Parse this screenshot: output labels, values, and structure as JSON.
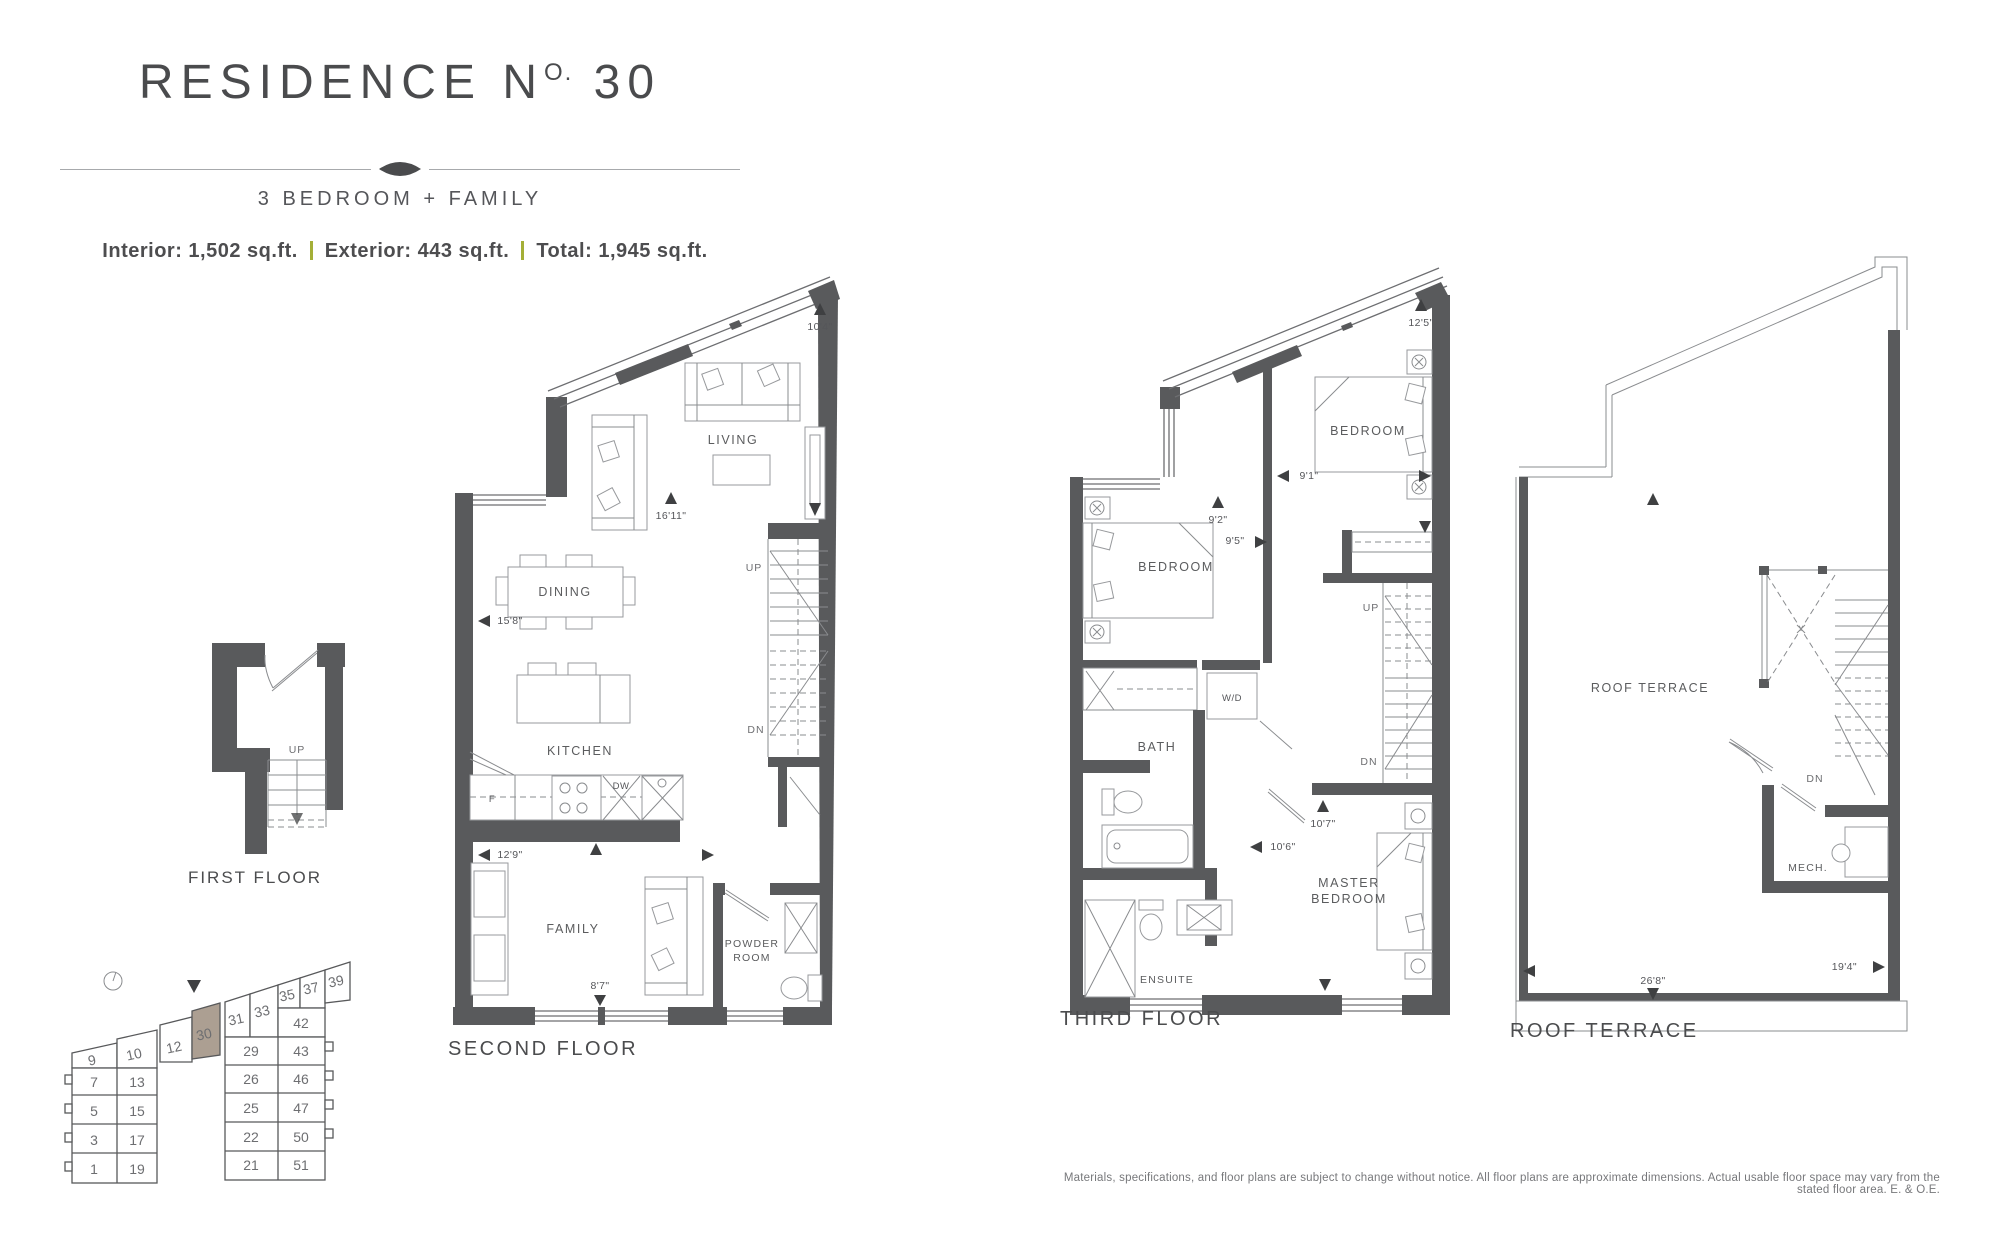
{
  "header": {
    "title_prefix": "RESIDENCE N",
    "title_sup": "O.",
    "title_suffix": "30",
    "subtitle": "3 BEDROOM + FAMILY",
    "stats": [
      "Interior: 1,502 sq.ft.",
      "Exterior: 443 sq.ft.",
      "Total: 1,945 sq.ft."
    ]
  },
  "floors": {
    "first": {
      "label": "FIRST FLOOR",
      "stairs": {
        "up": "UP"
      }
    },
    "second": {
      "label": "SECOND FLOOR",
      "rooms": {
        "living": "LIVING",
        "dining": "DINING",
        "kitchen": "KITCHEN",
        "family": "FAMILY",
        "powder1": "POWDER",
        "powder2": "ROOM"
      },
      "appliances": {
        "fridge": "F",
        "dishwasher": "DW"
      },
      "stairs": {
        "up": "UP",
        "dn": "DN"
      },
      "dims": {
        "living_width": "10'4\"",
        "living_depth": "16'11\"",
        "dining": "15'8\"",
        "family_width": "12'9\"",
        "family_depth": "8'7\""
      }
    },
    "third": {
      "label": "THIRD FLOOR",
      "rooms": {
        "bedroom_right": "BEDROOM",
        "bedroom_left": "BEDROOM",
        "bath": "BATH",
        "wd": "W/D",
        "master1": "MASTER",
        "master2": "BEDROOM",
        "ensuite": "ENSUITE"
      },
      "stairs": {
        "up": "UP",
        "dn": "DN"
      },
      "dims": {
        "bedroom_right_w": "12'5\"",
        "hall": "9'1\"",
        "bedroom_left_w": "9'2\"",
        "bedroom_left_d": "9'5\"",
        "master_w": "10'7\"",
        "master_d": "10'6\""
      }
    },
    "roof": {
      "label": "ROOF TERRACE",
      "rooms": {
        "terrace": "ROOF TERRACE",
        "mech": "MECH."
      },
      "stairs": {
        "dn": "DN"
      },
      "dims": {
        "width": "26'8\"",
        "depth": "19'4\""
      }
    }
  },
  "keyplan": {
    "highlighted_unit": "30",
    "units": [
      "9",
      "10",
      "12",
      "30",
      "31",
      "33",
      "35",
      "37",
      "39",
      "42",
      "29",
      "43",
      "26",
      "46",
      "25",
      "47",
      "22",
      "50",
      "21",
      "51",
      "7",
      "13",
      "5",
      "15",
      "3",
      "17",
      "1",
      "19"
    ]
  },
  "disclaimer": "Materials, specifications, and floor plans are subject to change without notice. All floor plans are approximate dimensions. Actual usable floor space may vary from the stated floor area. E. & O.E.",
  "colors": {
    "wall": "#595a5c",
    "accent_green": "#a4af37",
    "highlight_unit": "#ac9f92",
    "text": "#4d4d4f"
  }
}
